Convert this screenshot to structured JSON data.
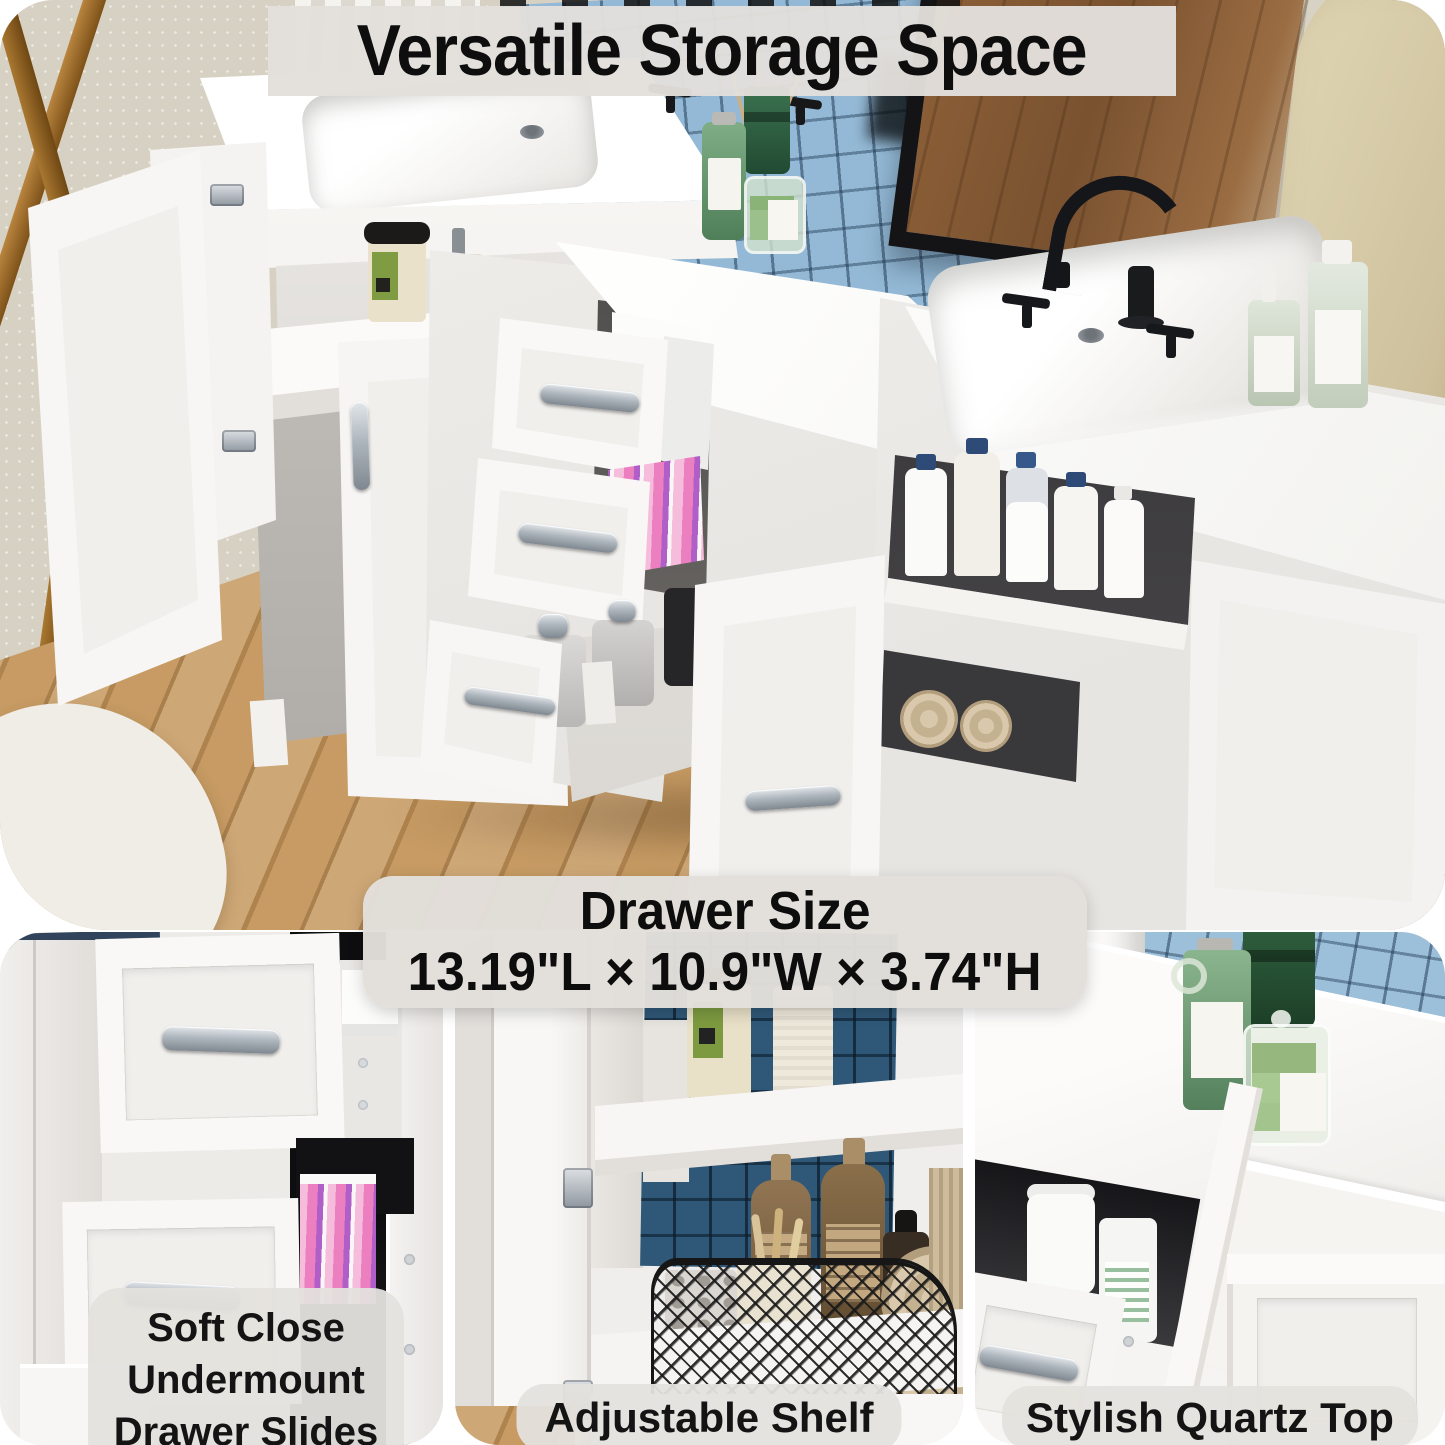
{
  "headline": {
    "text": "Versatile Storage Space"
  },
  "size_callout": {
    "title": "Drawer Size",
    "dimensions": "13.19\"L × 10.9\"W × 3.74\"H"
  },
  "features": [
    {
      "id": "drawer-slides",
      "lines": [
        "Soft Close",
        "Undermount",
        "Drawer Slides"
      ]
    },
    {
      "id": "adjustable-shelf",
      "label": "Adjustable Shelf"
    },
    {
      "id": "quartz-top",
      "label": "Stylish Quartz Top"
    }
  ],
  "palette": {
    "overlay_bg": "#E3E0DC",
    "text": "#0E0E0E",
    "tile_light_blue": "#93B9D6",
    "tile_dark_blue": "#2F5878",
    "tile_grout": "#24435C",
    "wood_floor": "#C79B63",
    "cream_wall": "#D8D2C5",
    "tan_wall": "#CFC29E",
    "gold_frame": "#A97832",
    "mirror_frame": "#141417",
    "mirror_wood": "#8E6138",
    "cabinet_white": "#F5F4F2",
    "counter_white": "#FBFAF9",
    "handle_silver": "#97A0A8",
    "faucet_black": "#18191C",
    "bottle_green": "#6FA076",
    "vase_green": "#275237",
    "soap_green": "#9EC188",
    "amber_bottle": "#8A6F4A",
    "kraft_label": "#C3A77F",
    "navy_cap": "#2D4B76",
    "pink_items": "#EC7FC0",
    "purple_items": "#8A63C2",
    "towel_beige": "#CDBB9C",
    "basket_black": "#1B1B1B"
  }
}
